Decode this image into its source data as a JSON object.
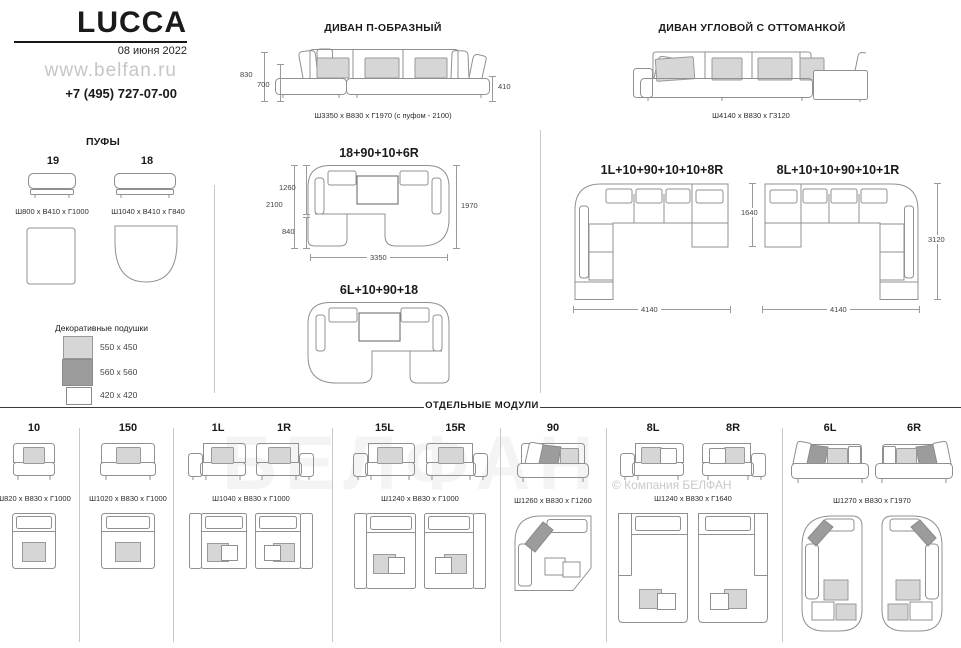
{
  "header": {
    "brand": "LUCCA",
    "date": "08 июня 2022",
    "website": "www.belfan.ru",
    "phone": "+7 (495) 727-07-00"
  },
  "poufs": {
    "title": "ПУФЫ",
    "items": [
      {
        "label": "19",
        "dims": "Ш800 х В410 х Г1000"
      },
      {
        "label": "18",
        "dims": "Ш1040 х В410 х Г840"
      }
    ]
  },
  "pillows": {
    "title": "Декоративные подушки",
    "items": [
      {
        "size": "550 x 450",
        "color": "#d6d6d6"
      },
      {
        "size": "560 x 560",
        "color": "#9c9c9c"
      },
      {
        "size": "420 x 420",
        "color": "#ffffff"
      }
    ]
  },
  "sofas": {
    "u_shaped": {
      "title": "ДИВАН П-ОБРАЗНЫЙ",
      "dims": "Ш3350 х В830 х Г1970 (с пуфом - 2100)",
      "dim_back": "830",
      "dim_seat": "700",
      "dim_arm": "410"
    },
    "corner": {
      "title": "ДИВАН УГЛОВОЙ С ОТТОМАНКОЙ",
      "dims": "Ш4140 х В830 х Г3120"
    },
    "config_u1": {
      "title": "18+90+10+6R",
      "dim_total_depth": "2100",
      "dim_upper": "1260",
      "dim_lower": "840",
      "dim_right": "1970",
      "dim_width": "3350"
    },
    "config_u2": {
      "title": "6L+10+90+18"
    },
    "config_corner1": {
      "title": "1L+10+90+10+10+8R",
      "dim_right": "1640",
      "dim_width": "4140"
    },
    "config_corner2": {
      "title": "8L+10+10+90+10+1R",
      "dim_right": "3120",
      "dim_width": "4140"
    }
  },
  "modules": {
    "title": "ОТДЕЛЬНЫЕ МОДУЛИ",
    "groups": [
      {
        "labels": [
          "10"
        ],
        "dims": "Ш820 х В830 х Г1000"
      },
      {
        "labels": [
          "150"
        ],
        "dims": "Ш1020 х В830 х Г1000"
      },
      {
        "labels": [
          "1L",
          "1R"
        ],
        "dims": "Ш1040 х В830 х Г1000"
      },
      {
        "labels": [
          "15L",
          "15R"
        ],
        "dims": "Ш1240 х В830 х Г1000"
      },
      {
        "labels": [
          "90"
        ],
        "dims": "Ш1260 х В830 х Г1260"
      },
      {
        "labels": [
          "8L",
          "8R"
        ],
        "dims": "Ш1240 х В830 х Г1640"
      },
      {
        "labels": [
          "6L",
          "6R"
        ],
        "dims": "Ш1270 х В830 х Г1970"
      }
    ]
  },
  "watermark": {
    "big": "БЕЛФАН",
    "copyright": "© Компания БЕЛФАН"
  },
  "colors": {
    "pillow_light": "#d6d6d6",
    "pillow_dark": "#9c9c9c",
    "drawing_line": "#909090",
    "divider": "#c9c9c9"
  }
}
